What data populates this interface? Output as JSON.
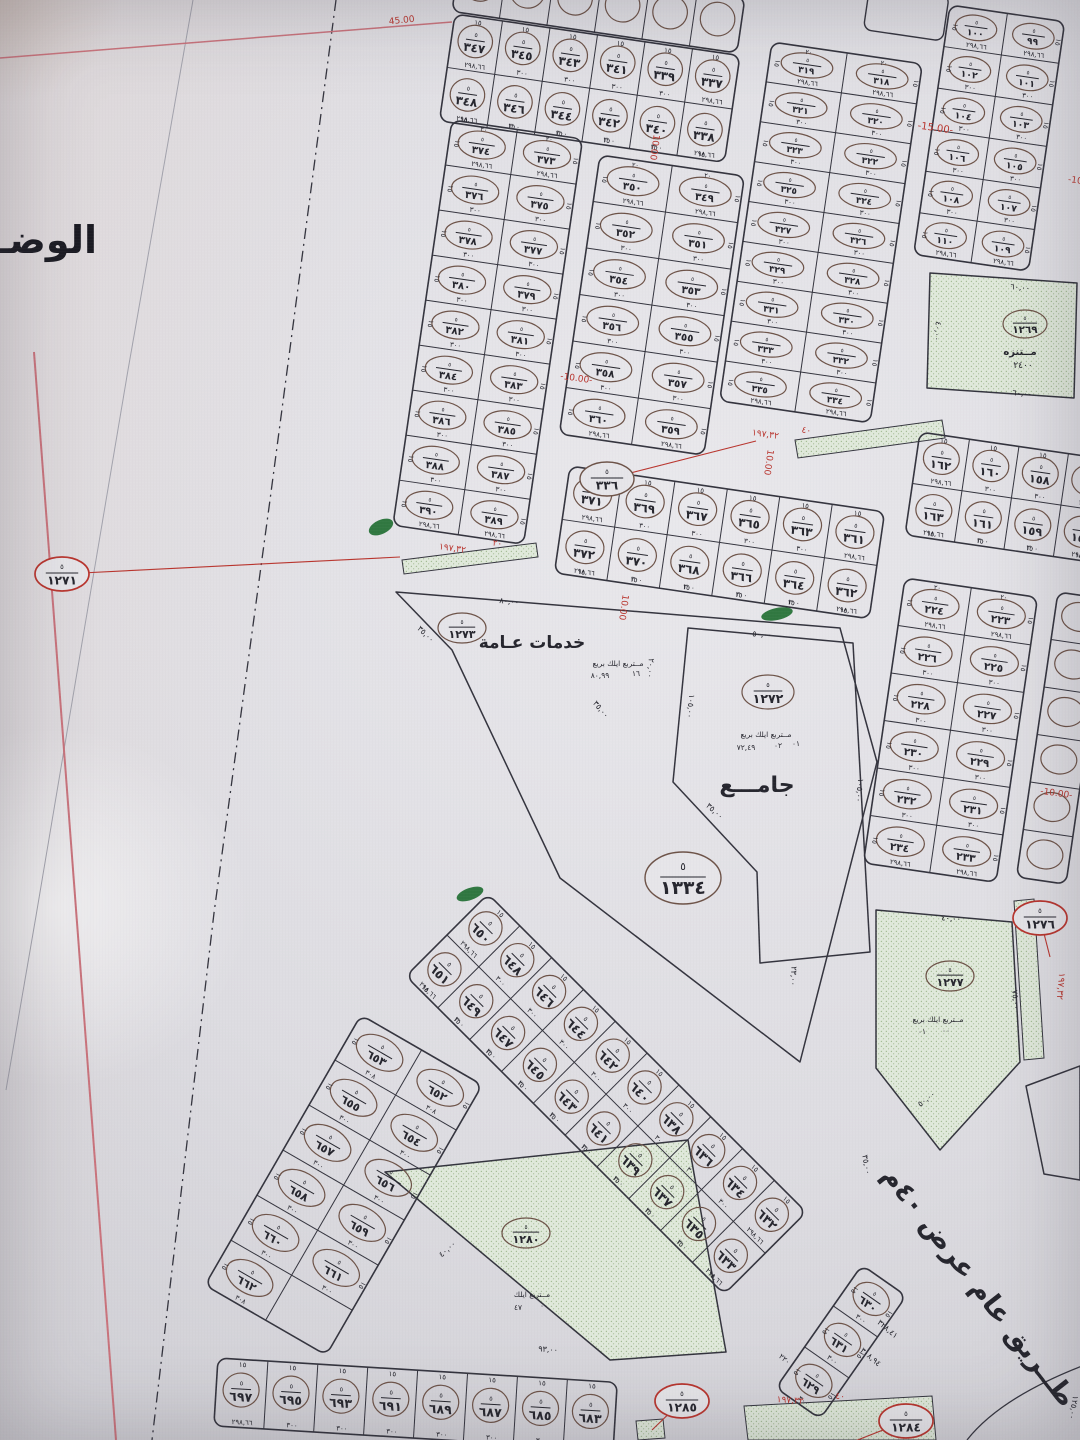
{
  "page": {
    "side_text": "الوضـــــ",
    "colors": {
      "ink": "#26262e",
      "line": "#34343e",
      "red": "#b9352e",
      "oval": "#6d5348",
      "green_fill": "#e0e9db",
      "green_dot": "#a3bb94",
      "green_dark": "#1d6b2f",
      "pink": "#c9737c",
      "grey": "#a2a2ac"
    }
  },
  "map": {
    "oval_numerator": "٥",
    "road_label": {
      "t": "طــريق عام عرض ٤٠م",
      "x": 972,
      "y": 1292,
      "r": 52,
      "s": 27
    },
    "blocks": [
      {
        "id": "block-337-348",
        "x": 455,
        "y": 14,
        "a": 8.3,
        "cw": 48,
        "ch": 54,
        "dir": "h",
        "w": "١٥",
        "ea": "٢٩٨,٦٦",
        "ma": "٣٠٠",
        "rows": [
          [
            "٣٤٧",
            "٣٤٥",
            "٣٤٣",
            "٣٤١",
            "٣٣٩",
            "٣٣٧"
          ],
          [
            "٣٤٨",
            "٣٤٦",
            "٣٤٤",
            "٣٤٢",
            "٣٤٠",
            "٣٣٨"
          ]
        ]
      },
      {
        "id": "block-373-390",
        "x": 452,
        "y": 120,
        "a": 8.3,
        "cw": 66,
        "ch": 45.5,
        "dir": "v",
        "w": "١٥",
        "d": "٢٠",
        "ea": "٢٩٨,٦٦",
        "ma": "٣٠٠",
        "rows": [
          [
            "٣٧٤",
            "٣٧٣"
          ],
          [
            "٣٧٦",
            "٣٧٥"
          ],
          [
            "٣٧٨",
            "٣٧٧"
          ],
          [
            "٣٨٠",
            "٣٧٩"
          ],
          [
            "٣٨٢",
            "٣٨١"
          ],
          [
            "٣٨٤",
            "٣٨٣"
          ],
          [
            "٣٨٦",
            "٣٨٥"
          ],
          [
            "٣٨٨",
            "٣٨٧"
          ],
          [
            "٣٩٠",
            "٣٨٩"
          ]
        ]
      },
      {
        "id": "block-349-360",
        "x": 600,
        "y": 155,
        "a": 8.3,
        "cw": 73,
        "ch": 47,
        "dir": "v",
        "w": "١٥",
        "d": "٢٠",
        "ea": "٢٩٨,٦٦",
        "ma": "٣٠٠",
        "rows": [
          [
            "٣٥٠",
            "٣٤٩"
          ],
          [
            "٣٥٢",
            "٣٥١"
          ],
          [
            "٣٥٤",
            "٣٥٣"
          ],
          [
            "٣٥٦",
            "٣٥٥"
          ],
          [
            "٣٥٨",
            "٣٥٧"
          ],
          [
            "٣٦٠",
            "٣٥٩"
          ]
        ]
      },
      {
        "id": "block-318-335",
        "x": 772,
        "y": 42,
        "a": 8.3,
        "cw": 76,
        "ch": 40.3,
        "dir": "v",
        "w": "١٥",
        "d": "٢٠",
        "ea": "٢٩٨,٦٦",
        "ma": "٣٠٠",
        "rows": [
          [
            "٣١٩",
            "٣١٨"
          ],
          [
            "٣٢١",
            "٣٢٠"
          ],
          [
            "٣٢٣",
            "٣٢٢"
          ],
          [
            "٣٢٥",
            "٣٢٤"
          ],
          [
            "٣٢٧",
            "٣٢٦"
          ],
          [
            "٣٢٩",
            "٣٢٨"
          ],
          [
            "٣٣١",
            "٣٣٠"
          ],
          [
            "٣٣٣",
            "٣٣٢"
          ],
          [
            "٣٣٥",
            "٣٣٤"
          ]
        ]
      },
      {
        "id": "block-361-372",
        "x": 570,
        "y": 466,
        "a": 8.3,
        "cw": 53,
        "ch": 54,
        "dir": "h",
        "w": "١٥",
        "ea": "٢٩٨,٦٦",
        "ma": "٣٠٠",
        "rows": [
          [
            "٣٧١",
            "٣٦٩",
            "٣٦٧",
            "٣٦٥",
            "٣٦٣",
            "٣٦١"
          ],
          [
            "٣٧٢",
            "٣٧٠",
            "٣٦٨",
            "٣٦٦",
            "٣٦٤",
            "٣٦٢"
          ]
        ]
      },
      {
        "id": "block-99-110",
        "x": 950,
        "y": 5,
        "a": 8.3,
        "cw": 58,
        "ch": 42,
        "dir": "v",
        "w": "١٥",
        "ea": "٢٩٨,٦٦",
        "ma": "٣٠٠",
        "rows": [
          [
            "١٠٠",
            "٩٩"
          ],
          [
            "١٠٢",
            "١٠١"
          ],
          [
            "١٠٤",
            "١٠٣"
          ],
          [
            "١٠٦",
            "١٠٥"
          ],
          [
            "١٠٨",
            "١٠٧"
          ],
          [
            "١١٠",
            "١٠٩"
          ]
        ]
      },
      {
        "id": "block-156-163",
        "x": 920,
        "y": 432,
        "a": 8.3,
        "cw": 50,
        "ch": 52,
        "dir": "h",
        "w": "١٥",
        "ea": "٢٩٨,٦٦",
        "ma": "٣٠٠",
        "rows": [
          [
            "١٦٢",
            "١٦٠",
            "١٥٨",
            "١٥٦"
          ],
          [
            "١٦٣",
            "١٦١",
            "١٥٩",
            "١٥٧"
          ]
        ]
      },
      {
        "id": "block-223-234",
        "x": 905,
        "y": 578,
        "a": 8.3,
        "cw": 67,
        "ch": 48,
        "dir": "v",
        "w": "١٥",
        "d": "٢٠",
        "ea": "٢٩٨,٦٦",
        "ma": "٣٠٠",
        "rows": [
          [
            "٢٢٤",
            "٢٢٣"
          ],
          [
            "٢٢٦",
            "٢٢٥"
          ],
          [
            "٢٢٨",
            "٢٢٧"
          ],
          [
            "٢٣٠",
            "٢٢٩"
          ],
          [
            "٢٣٢",
            "٢٣١"
          ],
          [
            "٢٣٤",
            "٢٣٣"
          ]
        ]
      },
      {
        "id": "strip-632-651",
        "x": 488,
        "y": 894,
        "a": 45,
        "cw": 45,
        "ch": 58,
        "dir": "h",
        "w": "١٥",
        "ea": "٢٩٨,٦٦",
        "ma": "٣٠٠",
        "rows": [
          [
            "٦٥٠",
            "٦٤٨",
            "٦٤٦",
            "٦٤٤",
            "٦٤٢",
            "٦٤٠",
            "٦٣٨",
            "٦٣٦",
            "٦٣٤",
            "٦٣٢"
          ],
          [
            "٦٥١",
            "٦٤٩",
            "٦٤٧",
            "٦٤٥",
            "٦٤٣",
            "٦٤١",
            "٦٣٩",
            "٦٣٧",
            "٦٣٥",
            "٦٣٣"
          ]
        ]
      },
      {
        "id": "block-652-662",
        "x": 361,
        "y": 1015,
        "a": 30,
        "cw": 70,
        "ch": 52,
        "dir": "v",
        "w": "١٥",
        "ea": "٣٠٨",
        "ma": "٣٠٠",
        "rows": [
          [
            "٦٥٣",
            "٦٥٢"
          ],
          [
            "٦٥٥",
            "٦٥٤"
          ],
          [
            "٦٥٧",
            "٦٥٦"
          ],
          [
            "٦٥٨",
            "٦٥٩"
          ],
          [
            "٦٦٠",
            "٦٦١"
          ],
          [
            "٦٦٢",
            ""
          ]
        ]
      },
      {
        "id": "block-629-631",
        "x": 862,
        "y": 1265,
        "a": 35,
        "cw": 54,
        "ch": 50,
        "dir": "v",
        "w": "١٥",
        "ea": "٣٠٠",
        "ma": "٣٠٠",
        "rows": [
          [
            "٦٣٠"
          ],
          [
            "٦٣١"
          ],
          [
            "٦٢٩"
          ]
        ]
      },
      {
        "id": "block-683-697",
        "x": 218,
        "y": 1358,
        "a": 3.5,
        "cw": 50,
        "ch": 68,
        "dir": "h",
        "w": "١٥",
        "ea": "٢٩٨,٦٦",
        "ma": "٣٠٠",
        "rows": [
          [
            "٦٩٧",
            "٦٩٥",
            "٦٩٣",
            "٦٩١",
            "٦٨٩",
            "٦٨٧",
            "٦٨٥",
            "٦٨٣"
          ]
        ]
      },
      {
        "id": "fragment-top-row",
        "x": 460,
        "y": -44,
        "a": 8.3,
        "cw": 48,
        "ch": 56,
        "dir": "h",
        "empty_ovals": true,
        "rows": [
          [
            "",
            "",
            "",
            "",
            "",
            ""
          ]
        ]
      },
      {
        "id": "fragment-right-column",
        "x": 1058,
        "y": 592,
        "a": 8.3,
        "cw": 50,
        "ch": 48,
        "dir": "v",
        "empty_ovals": true,
        "rows": [
          [
            ""
          ],
          [
            ""
          ],
          [
            ""
          ],
          [
            ""
          ],
          [
            ""
          ],
          [
            ""
          ]
        ]
      }
    ],
    "parcels": [
      {
        "id": "parcel-services",
        "green": false,
        "pts": "396,592 840,628 877,762 800,1062 560,878 452,650",
        "oval": {
          "x": 462,
          "y": 628,
          "n": "١٢٧٣",
          "rx": 24,
          "ry": 15
        },
        "labels": [
          {
            "t": "خدمات عـامة",
            "x": 532,
            "y": 648,
            "s": 17,
            "b": 1
          },
          {
            "t": "مــتربع ايلك بريع",
            "x": 618,
            "y": 666,
            "s": 7.5
          },
          {
            "t": "٨٠,٩٩",
            "x": 600,
            "y": 678,
            "s": 7.5
          },
          {
            "t": "١٦",
            "x": 636,
            "y": 676,
            "s": 7.5
          }
        ]
      },
      {
        "id": "parcel-mosque",
        "green": false,
        "pts": "688,628 853,643 870,952 760,963 757,872 673,782",
        "oval": {
          "x": 768,
          "y": 692,
          "n": "١٢٧٢",
          "rx": 26,
          "ry": 17
        },
        "labels": [
          {
            "t": "مــتربع ايلك بريع",
            "x": 766,
            "y": 737,
            "s": 7.5
          },
          {
            "t": "٧٢,٤٩",
            "x": 746,
            "y": 750,
            "s": 7.5
          },
          {
            "t": "٠٢",
            "x": 778,
            "y": 748,
            "s": 7.5
          },
          {
            "t": "٠١",
            "x": 796,
            "y": 746,
            "s": 7.5
          },
          {
            "t": "جامـــع",
            "x": 757,
            "y": 792,
            "s": 22,
            "b": 1
          }
        ]
      },
      {
        "id": "parcel-park-1269",
        "green": true,
        "pts": "930,273 1077,283 1074,398 927,388",
        "oval": {
          "x": 1025,
          "y": 324,
          "n": "١٢٦٩",
          "rx": 22,
          "ry": 14
        },
        "labels": [
          {
            "t": "مــتنزه",
            "x": 1020,
            "y": 355,
            "s": 10,
            "b": 1
          },
          {
            "t": "٢٤٠٠",
            "x": 1023,
            "y": 368,
            "s": 9
          }
        ]
      },
      {
        "id": "parcel-park-1277",
        "green": true,
        "pts": "876,910 1012,922 1020,1062 940,1150 876,1068",
        "oval": {
          "x": 950,
          "y": 976,
          "n": "١٢٧٧",
          "rx": 24,
          "ry": 15
        },
        "labels": [
          {
            "t": "مــتربع ايلك بريع",
            "x": 938,
            "y": 1022,
            "s": 7.5
          },
          {
            "t": "٠١",
            "x": 922,
            "y": 1034,
            "s": 7.5
          },
          {
            "t": "٠٠",
            "x": 946,
            "y": 1033,
            "s": 7.5
          }
        ]
      },
      {
        "id": "parcel-park-1280",
        "green": true,
        "pts": "385,1172 688,1140 726,1352 610,1360",
        "oval": {
          "x": 526,
          "y": 1233,
          "n": "١٢٨٠",
          "rx": 24,
          "ry": 15
        },
        "labels": [
          {
            "t": "مــتربع ايلك",
            "x": 532,
            "y": 1297,
            "s": 7.5
          },
          {
            "t": "٤٧",
            "x": 518,
            "y": 1310,
            "s": 7.5
          },
          {
            "t": "٠٠",
            "x": 544,
            "y": 1308,
            "s": 7.5
          }
        ]
      },
      {
        "id": "parcel-road-side",
        "green": false,
        "pts": "1026,1086 1080,1066 1080,1180 1044,1174",
        "labels": []
      }
    ],
    "ovals": [
      {
        "n": "١٢٧١",
        "x": 62,
        "y": 574,
        "red": 1,
        "lx": 400,
        "ly": 557
      },
      {
        "n": "٣٣٦",
        "x": 607,
        "y": 479,
        "red": 0,
        "lx": 756,
        "ly": 441
      },
      {
        "n": "١٢٧٦",
        "x": 1040,
        "y": 918,
        "red": 1,
        "lx": 1050,
        "ly": 957
      },
      {
        "n": "١٢٨٤",
        "x": 906,
        "y": 1421,
        "red": 1,
        "lx": 855,
        "ly": 1441
      },
      {
        "n": "١٢٨٥",
        "x": 682,
        "y": 1401,
        "red": 1,
        "lx": 652,
        "ly": 1430
      },
      {
        "n": "١٣٣٤",
        "x": 683,
        "y": 878,
        "red": 0,
        "big": 1
      }
    ],
    "annotations": [
      {
        "t": "-15.00-",
        "x": 935,
        "y": 131,
        "r": 8,
        "s": 10,
        "c": "red"
      },
      {
        "t": "10.00",
        "x": 652,
        "y": 147,
        "r": 98,
        "s": 9,
        "c": "red"
      },
      {
        "t": "-10.00-",
        "x": 576,
        "y": 381,
        "r": 8,
        "s": 9,
        "c": "red"
      },
      {
        "t": "10.00",
        "x": 766,
        "y": 462,
        "r": 98,
        "s": 9,
        "c": "red"
      },
      {
        "t": "10.00",
        "x": 621,
        "y": 607,
        "r": 98,
        "s": 9,
        "c": "red"
      },
      {
        "t": "-10.00-",
        "x": 1056,
        "y": 796,
        "r": 8,
        "s": 9,
        "c": "red"
      },
      {
        "t": "-10",
        "x": 1075,
        "y": 183,
        "r": 8,
        "s": 9,
        "c": "red"
      },
      {
        "t": "45.00",
        "x": 402,
        "y": 23,
        "r": -6,
        "s": 9,
        "c": "red"
      },
      {
        "t": "١٩٧,٣٢",
        "x": 765,
        "y": 437,
        "r": 8,
        "s": 9,
        "c": "red"
      },
      {
        "t": "٤٠",
        "x": 806,
        "y": 433,
        "r": 8,
        "s": 9,
        "c": "red"
      },
      {
        "t": "١٩٧,٣٢",
        "x": 452,
        "y": 551,
        "r": 8,
        "s": 9,
        "c": "red"
      },
      {
        "t": "٢٠",
        "x": 497,
        "y": 546,
        "r": 8,
        "s": 9,
        "c": "red"
      },
      {
        "t": "١٩٧,٣٢",
        "x": 790,
        "y": 1403,
        "r": 4,
        "s": 9,
        "c": "red"
      },
      {
        "t": "٤٠",
        "x": 840,
        "y": 1399,
        "r": 4,
        "s": 9,
        "c": "red"
      },
      {
        "t": "١٩٧,٣٢",
        "x": 1058,
        "y": 986,
        "r": 95,
        "s": 9,
        "c": "red"
      },
      {
        "t": "٨٠,٠٠",
        "x": 509,
        "y": 604,
        "r": 6,
        "s": 8
      },
      {
        "t": "٣٥,٠٠",
        "x": 424,
        "y": 636,
        "r": 44,
        "s": 8
      },
      {
        "t": "٣٥,٠٠",
        "x": 599,
        "y": 711,
        "r": 50,
        "s": 8
      },
      {
        "t": "٢٠,٠٠",
        "x": 648,
        "y": 668,
        "r": 95,
        "s": 8
      },
      {
        "t": "٥٠,٠٠",
        "x": 762,
        "y": 637,
        "r": 4,
        "s": 8
      },
      {
        "t": "١٠٥,٠٠",
        "x": 857,
        "y": 790,
        "r": 96,
        "s": 8
      },
      {
        "t": "١٠٥,٠٠",
        "x": 688,
        "y": 706,
        "r": 96,
        "s": 8
      },
      {
        "t": "٣٥,٠٠",
        "x": 713,
        "y": 813,
        "r": 42,
        "s": 8
      },
      {
        "t": "٢٣,٠٠",
        "x": 791,
        "y": 976,
        "r": 93,
        "s": 8
      },
      {
        "t": "٦٠,٠٠",
        "x": 1020,
        "y": 290,
        "r": 5,
        "s": 8
      },
      {
        "t": "٦٠,٠٠",
        "x": 1022,
        "y": 396,
        "r": 5,
        "s": 8
      },
      {
        "t": "٤٠,٠٠",
        "x": 935,
        "y": 331,
        "r": 95,
        "s": 8
      },
      {
        "t": "٤٠,٠٠",
        "x": 951,
        "y": 921,
        "r": 4,
        "s": 8
      },
      {
        "t": "٧٥,٠٠",
        "x": 1013,
        "y": 1000,
        "r": 85,
        "s": 8
      },
      {
        "t": "٥٠,٠٠",
        "x": 928,
        "y": 1101,
        "r": -38,
        "s": 8
      },
      {
        "t": "٩٣,٠٠",
        "x": 548,
        "y": 1352,
        "r": 4,
        "s": 8
      },
      {
        "t": "٤٠,٠٠",
        "x": 449,
        "y": 1251,
        "r": -42,
        "s": 8
      },
      {
        "t": "٣٥,٠٠",
        "x": 864,
        "y": 1165,
        "r": 80,
        "s": 8
      },
      {
        "t": "٣٢٨,٤١",
        "x": 886,
        "y": 1331,
        "r": 40,
        "s": 8
      },
      {
        "t": "٣٠٨,٩٤",
        "x": 869,
        "y": 1359,
        "r": 40,
        "s": 8
      },
      {
        "t": "٢٢٠",
        "x": 783,
        "y": 1361,
        "r": 40,
        "s": 7.5
      },
      {
        "t": "١٢٥,٠٠",
        "x": 1071,
        "y": 1407,
        "r": 100,
        "s": 8
      }
    ],
    "green_strips": [
      {
        "id": "strip-plot-336",
        "pts": "795,440 942,420 945,438 798,458"
      },
      {
        "id": "strip-plot-1271",
        "pts": "402,560 536,543 538,557 404,574"
      },
      {
        "id": "strip-plot-1276",
        "pts": "1014,901 1034,899 1044,1058 1024,1060"
      },
      {
        "id": "strip-plot-1284",
        "pts": "744,1406 932,1396 936,1440 748,1440"
      },
      {
        "id": "strip-plot-1285",
        "pts": "636,1421 663,1419 665,1438 638,1440"
      }
    ],
    "green_marks": [
      {
        "x": 381,
        "y": 527,
        "rx": 13,
        "ry": 7,
        "r": -25
      },
      {
        "x": 470,
        "y": 894,
        "rx": 14,
        "ry": 6,
        "r": -20
      },
      {
        "x": 777,
        "y": 614,
        "rx": 16,
        "ry": 6,
        "r": -12
      }
    ],
    "lines": [
      {
        "id": "boundary-dashdot",
        "pts": "336,0 270,500 214,913 152,1440",
        "c": "line",
        "w": 1.3,
        "dash": "11 5 2 5"
      },
      {
        "id": "paper-fold-line",
        "pts": "193,0 128,370 36,916 6,1090",
        "c": "grey",
        "w": 1
      },
      {
        "id": "pink-edge-top",
        "pts": "0,58 452,22",
        "c": "pink",
        "w": 1.5
      },
      {
        "id": "pink-edge-left",
        "pts": "34,352 116,1440",
        "c": "pink",
        "w": 2
      }
    ],
    "curves": [
      {
        "id": "road-corner-curve",
        "d": "M 967 1440 Q 1000 1398 1082 1366",
        "w": 1.3
      }
    ],
    "fragment_rects": [
      {
        "id": "fragment-parcel-topright",
        "x": 870,
        "y": -16,
        "w": 80,
        "h": 46,
        "a": 8.3
      }
    ]
  }
}
